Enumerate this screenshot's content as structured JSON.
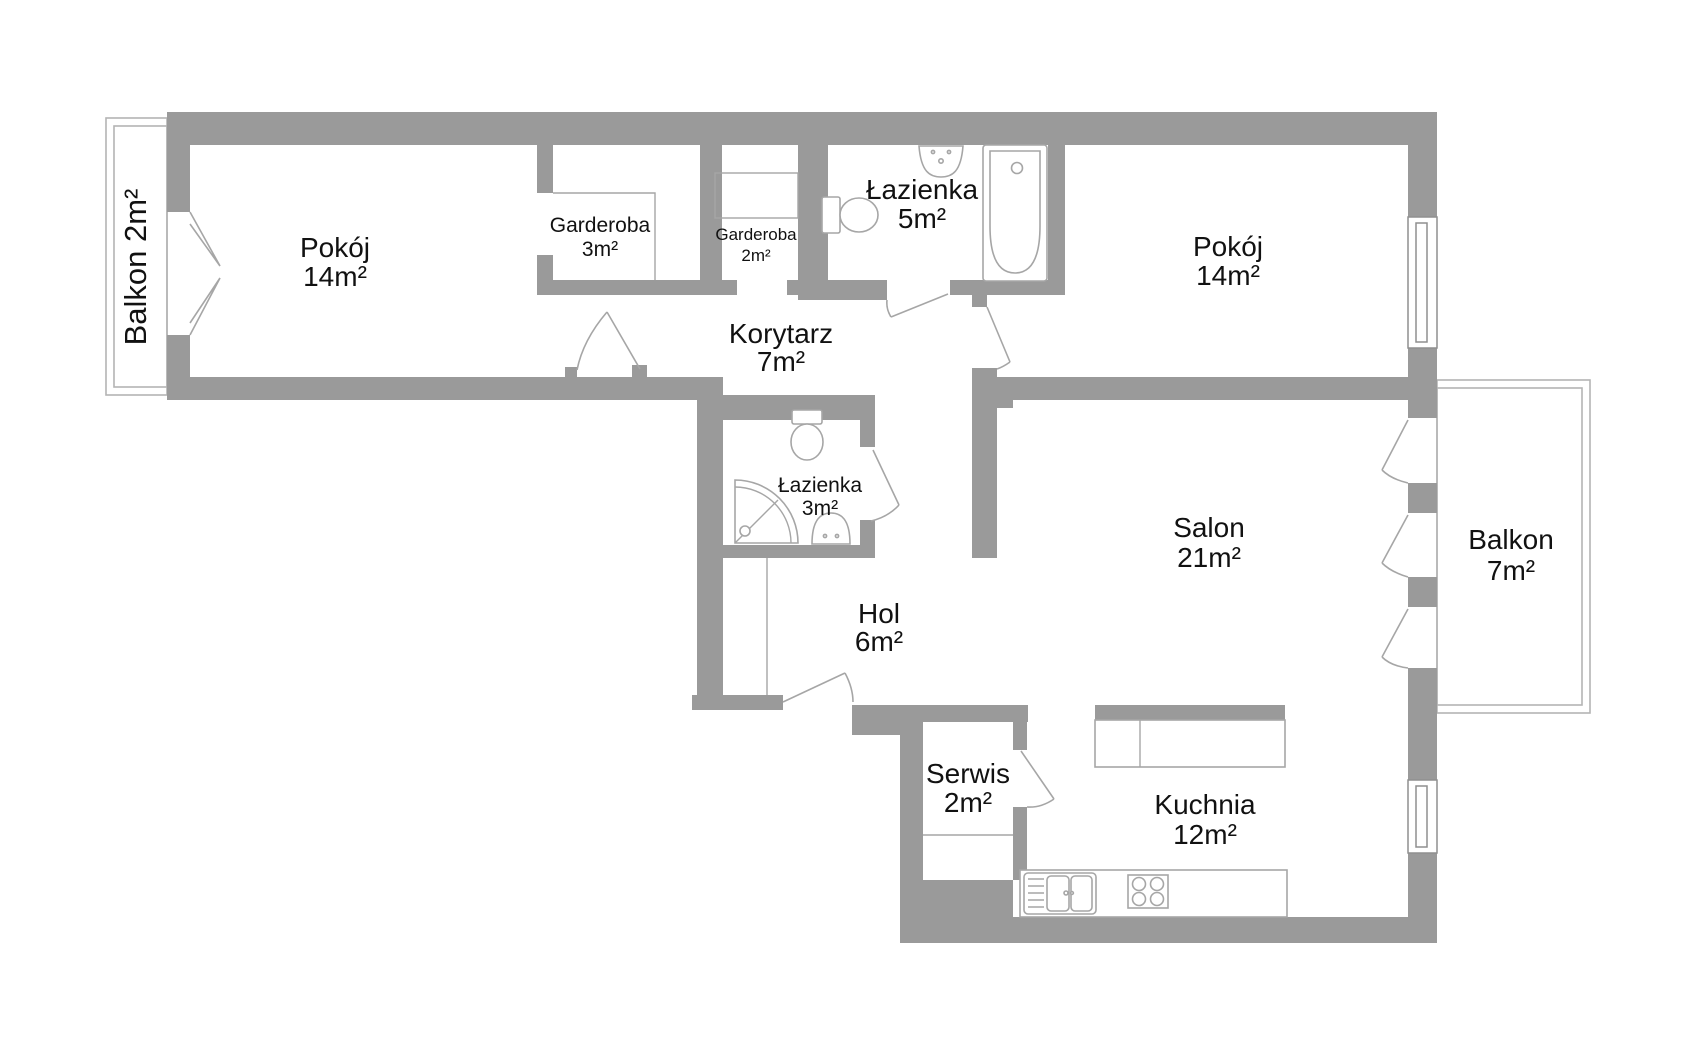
{
  "colors": {
    "wall": "#9a9a9a",
    "line": "#a6a6a6",
    "balcony_line": "#b4b4b4",
    "window_line": "#8f8f8f",
    "text": "#111111",
    "bg": "#ffffff"
  },
  "rooms": {
    "balkon_left": {
      "label": "Balkon 2m²"
    },
    "pokoj_left": {
      "name": "Pokój",
      "area": "14m²"
    },
    "garderoba_3": {
      "name": "Garderoba",
      "area": "3m²"
    },
    "garderoba_2": {
      "name": "Garderoba",
      "area": "2m²"
    },
    "lazienka_5": {
      "name": "Łazienka",
      "area": "5m²"
    },
    "pokoj_right": {
      "name": "Pokój",
      "area": "14m²"
    },
    "korytarz": {
      "name": "Korytarz",
      "area": "7m²"
    },
    "lazienka_3": {
      "name": "Łazienka",
      "area": "3m²"
    },
    "salon": {
      "name": "Salon",
      "area": "21m²"
    },
    "balkon_right": {
      "name": "Balkon",
      "area": "7m²"
    },
    "hol": {
      "name": "Hol",
      "area": "6m²"
    },
    "serwis": {
      "name": "Serwis",
      "area": "2m²"
    },
    "kuchnia": {
      "name": "Kuchnia",
      "area": "12m²"
    }
  }
}
